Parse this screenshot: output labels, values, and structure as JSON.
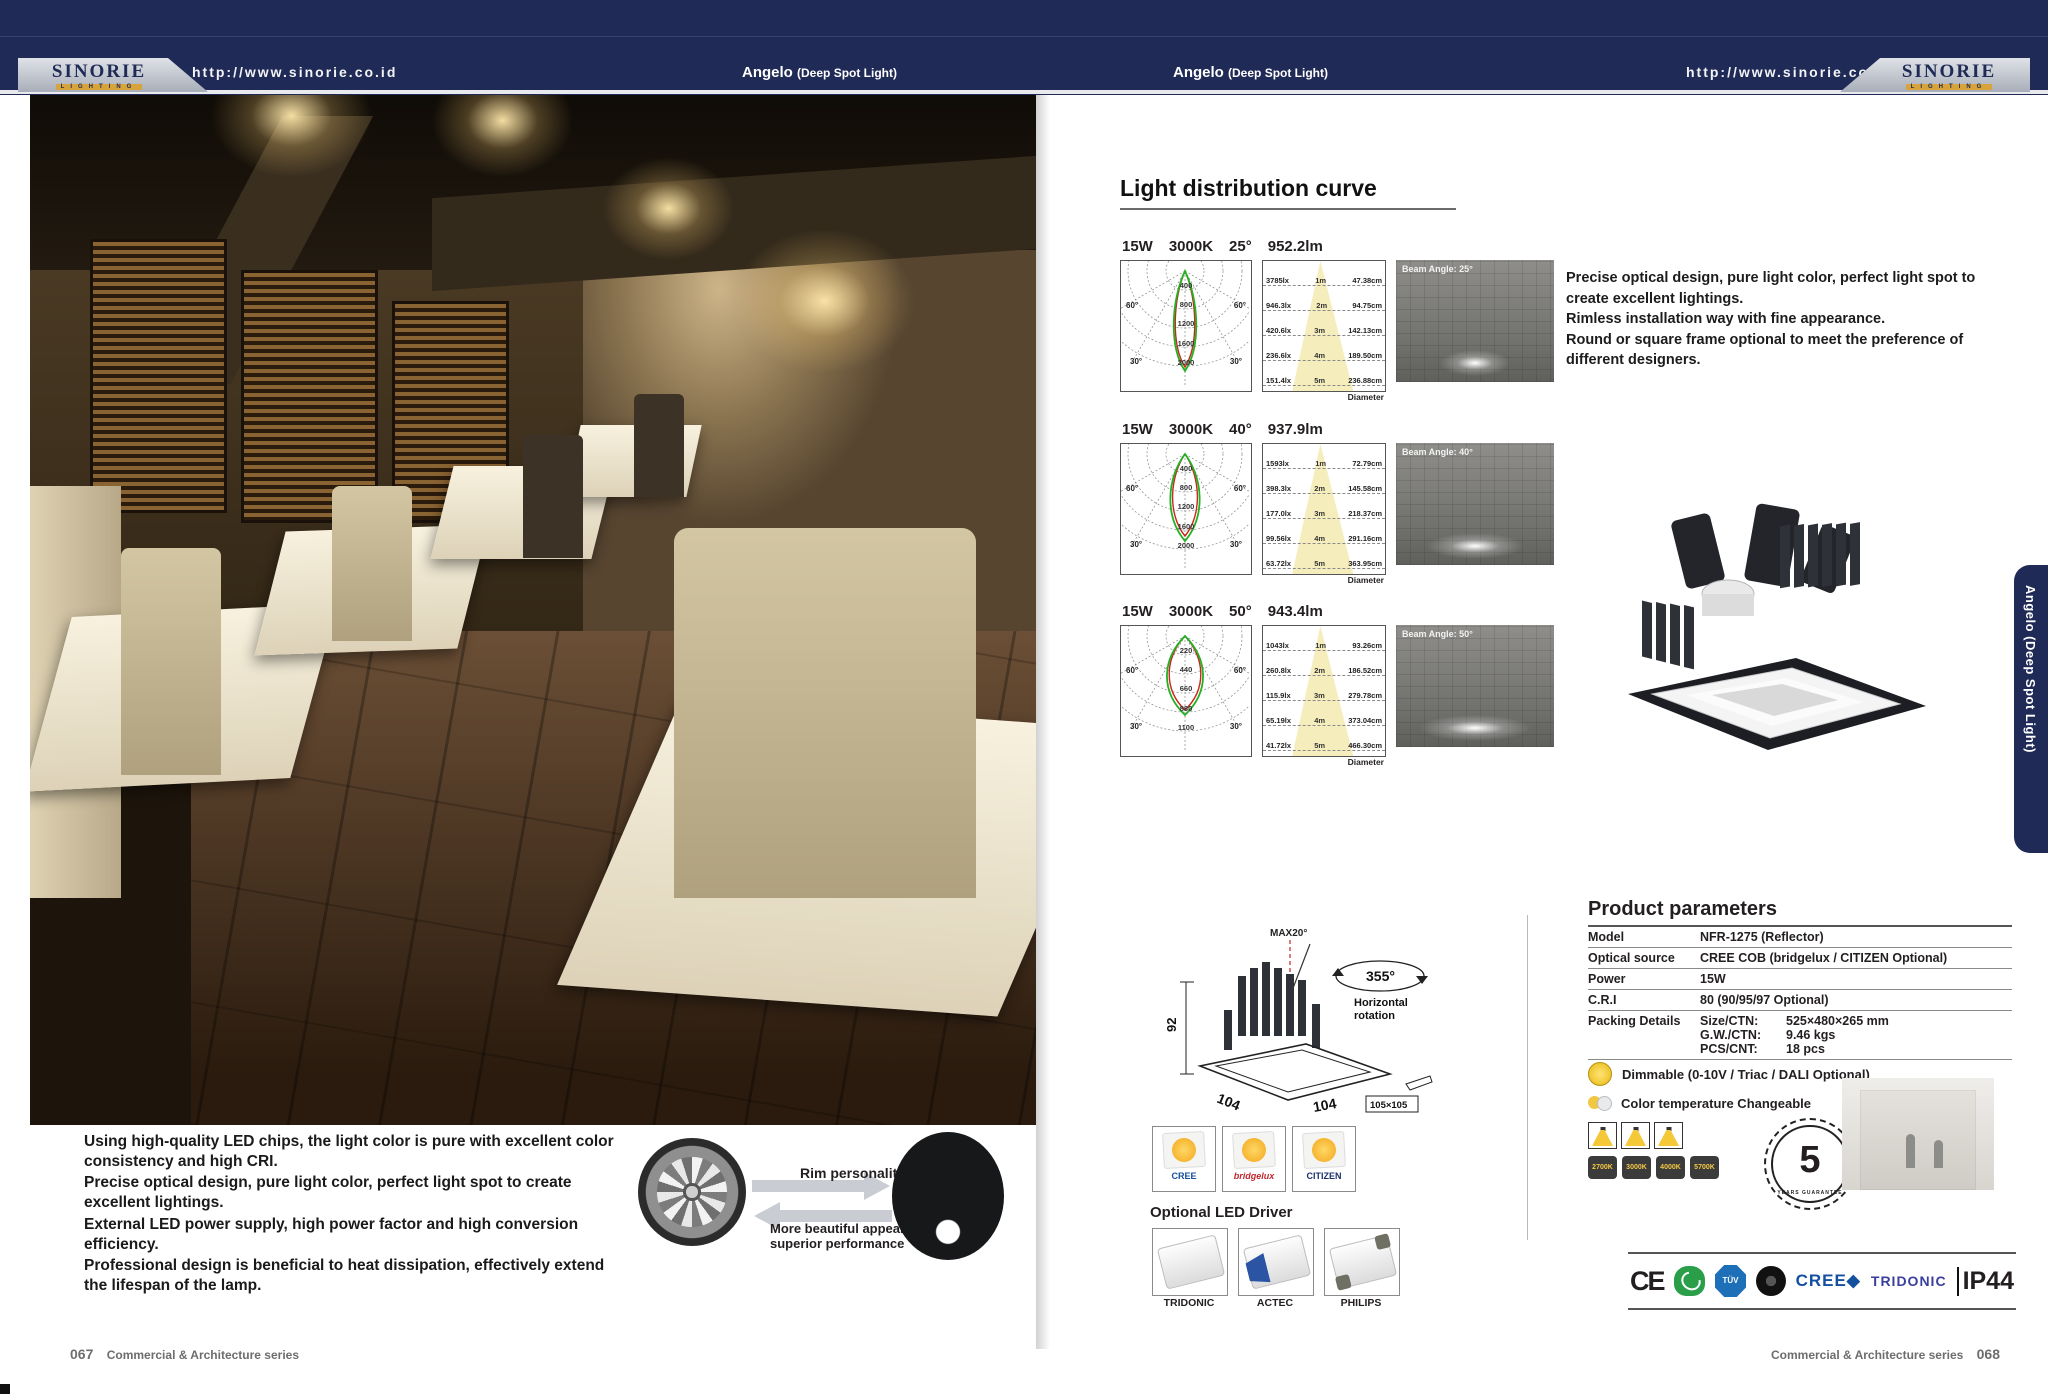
{
  "header": {
    "brand": "SINORIE",
    "brand_sub": "LIGHTING",
    "url": "http://www.sinorie.co.id",
    "product_title": "Angelo",
    "product_subtitle": "(Deep Spot Light)"
  },
  "side_tab": {
    "label": "Angelo (Deep Spot Light)"
  },
  "footer": {
    "left_page_no": "067",
    "right_page_no": "068",
    "series": "Commercial & Architecture series"
  },
  "left_page": {
    "description": [
      "Using high-quality LED chips, the light color is pure with excellent color consistency and high CRI.",
      "Precise optical design, pure light color, perfect light spot to create excellent lightings.",
      "External LED power supply, high power factor and high conversion efficiency.",
      "Professional design is beneficial to heat dissipation, effectively extend the lifespan of the lamp."
    ],
    "rim": {
      "title": "Rim personality design.",
      "subtitle": "More beautiful appearance, superior performance"
    }
  },
  "curves": {
    "heading": "Light distribution curve",
    "diameter_label": "Diameter",
    "angle_labels": {
      "left60": "60°",
      "right60": "60°",
      "left30": "30°",
      "right30": "30°"
    },
    "rows": [
      {
        "power": "15W",
        "cct": "3000K",
        "angle": "25°",
        "flux": "952.2lm",
        "beam_label": "Beam Angle: 25°",
        "rings": [
          "400",
          "800",
          "1200",
          "1600",
          "2000"
        ],
        "table": [
          {
            "lux": "3785lx",
            "dist": "1m",
            "dia": "47.38cm"
          },
          {
            "lux": "946.3lx",
            "dist": "2m",
            "dia": "94.75cm"
          },
          {
            "lux": "420.6lx",
            "dist": "3m",
            "dia": "142.13cm"
          },
          {
            "lux": "236.6lx",
            "dist": "4m",
            "dia": "189.50cm"
          },
          {
            "lux": "151.4lx",
            "dist": "5m",
            "dia": "236.88cm"
          }
        ]
      },
      {
        "power": "15W",
        "cct": "3000K",
        "angle": "40°",
        "flux": "937.9lm",
        "beam_label": "Beam Angle: 40°",
        "rings": [
          "400",
          "800",
          "1200",
          "1600",
          "2000"
        ],
        "table": [
          {
            "lux": "1593lx",
            "dist": "1m",
            "dia": "72.79cm"
          },
          {
            "lux": "398.3lx",
            "dist": "2m",
            "dia": "145.58cm"
          },
          {
            "lux": "177.0lx",
            "dist": "3m",
            "dia": "218.37cm"
          },
          {
            "lux": "99.56lx",
            "dist": "4m",
            "dia": "291.16cm"
          },
          {
            "lux": "63.72lx",
            "dist": "5m",
            "dia": "363.95cm"
          }
        ]
      },
      {
        "power": "15W",
        "cct": "3000K",
        "angle": "50°",
        "flux": "943.4lm",
        "beam_label": "Beam Angle: 50°",
        "rings": [
          "220",
          "440",
          "660",
          "880",
          "1100"
        ],
        "table": [
          {
            "lux": "1043lx",
            "dist": "1m",
            "dia": "93.26cm"
          },
          {
            "lux": "260.8lx",
            "dist": "2m",
            "dia": "186.52cm"
          },
          {
            "lux": "115.9lx",
            "dist": "3m",
            "dia": "279.78cm"
          },
          {
            "lux": "65.19lx",
            "dist": "4m",
            "dia": "373.04cm"
          },
          {
            "lux": "41.72lx",
            "dist": "5m",
            "dia": "466.30cm"
          }
        ]
      }
    ]
  },
  "intro": [
    "Precise optical design, pure light color, perfect light spot to create excellent lightings.",
    "Rimless installation way with fine appearance.",
    "Round or square frame optional to meet the preference of different designers."
  ],
  "dimensions": {
    "tilt": "MAX20°",
    "rotation": "355°",
    "rotation_note_1": "Horizontal",
    "rotation_note_2": "rotation",
    "height": "92",
    "side": "104",
    "front": "104",
    "cutout": "105×105"
  },
  "chips": [
    {
      "name": "CREE"
    },
    {
      "name": "bridgelux"
    },
    {
      "name": "CITIZEN"
    }
  ],
  "drivers": {
    "heading": "Optional LED Driver",
    "items": [
      {
        "name": "TRIDONIC"
      },
      {
        "name": "ACTEC"
      },
      {
        "name": "PHILIPS"
      }
    ]
  },
  "parameters": {
    "heading": "Product parameters",
    "rows": [
      {
        "label": "Model",
        "value": "NFR-1275  (Reflector)"
      },
      {
        "label": "Optical source",
        "value": "CREE COB (bridgelux / CITIZEN Optional)"
      },
      {
        "label": "Power",
        "value": "15W"
      },
      {
        "label": "C.R.I",
        "value": "80 (90/95/97 Optional)"
      }
    ],
    "packing": {
      "label": "Packing Details",
      "lines": [
        {
          "k": "Size/CTN:",
          "v": "525×480×265 mm"
        },
        {
          "k": "G.W./CTN:",
          "v": "9.46 kgs"
        },
        {
          "k": "PCS/CNT:",
          "v": "18 pcs"
        }
      ]
    },
    "dimmable": "Dimmable (0-10V / Triac / DALI Optional)",
    "cct_changeable": "Color temperature Changeable",
    "warranty": {
      "number": "5",
      "text": "YEARS GUARANTEE"
    }
  },
  "cct_chips": [
    "2700K",
    "3000K",
    "4000K",
    "5700K"
  ],
  "certs": {
    "ce": "CE",
    "tuv": "TÜV",
    "cree": "CREE◆",
    "tridonic": "TRIDONIC",
    "ip": "IP44"
  }
}
